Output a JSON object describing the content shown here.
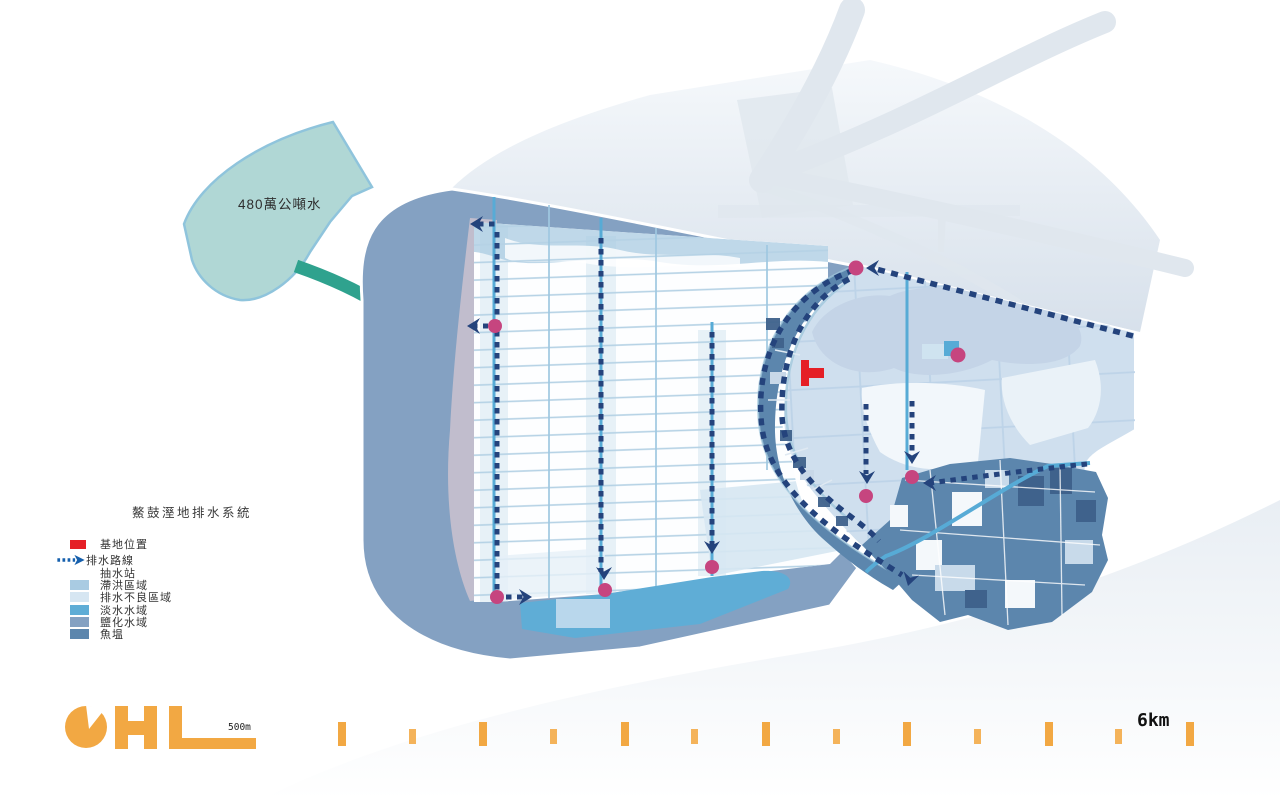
{
  "map": {
    "water_annotation": "480萬公噸水",
    "scalebar_label": "500m",
    "ruler_end_label": "6km"
  },
  "legend": {
    "title": "鰲鼓溼地排水系統",
    "items": [
      {
        "label": "基地位置",
        "swatch": "site"
      },
      {
        "label": "排水路線",
        "swatch": "route"
      },
      {
        "label": "抽水站",
        "swatch": "none"
      },
      {
        "label": "滯洪區域",
        "swatch": "flood"
      },
      {
        "label": "排水不良區域",
        "swatch": "poor"
      },
      {
        "label": "淡水水域",
        "swatch": "fresh"
      },
      {
        "label": "鹽化水域",
        "swatch": "salt"
      },
      {
        "label": "魚塭",
        "swatch": "pond"
      }
    ]
  },
  "colors": {
    "route_navy": "#24437c",
    "legend_arrow_blue": "#1660ad",
    "pump_pink": "#c6457f",
    "site_red": "#e51f26",
    "salt_water": "#84a1c2",
    "fresh_water": "#5fadd6",
    "fish_pond": "#5c86ad",
    "flood_area": "#a9cbe2",
    "poor_drainage": "#d6e6f2",
    "flood_light": "#cfdfee",
    "lavender": "#c4bfce",
    "channel_cyan": "#57abd6",
    "grid_line": "#b5d2e5",
    "right_grid_line": "#bdd3e8",
    "cloud": "#c4d4e7",
    "river_gray": "#e0e7ee",
    "teal_fill": "#b0d7d5",
    "teal_border": "#8fc4dc",
    "teal_arrow": "#2fa28e",
    "orange": "#f2a843",
    "pale_wash": "#d6e7f2",
    "text_dark": "#333333"
  }
}
